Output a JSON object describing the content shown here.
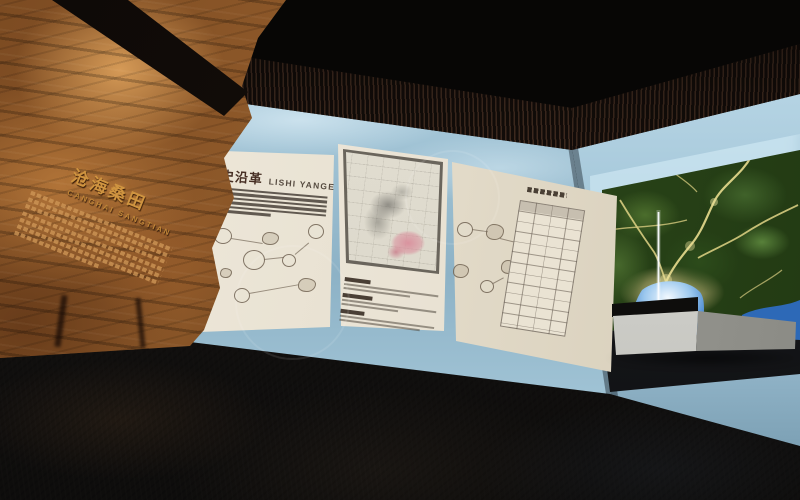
{
  "scene": {
    "type": "museum-exhibition-hall-3d-render",
    "areas": [
      "rock-relief-wall",
      "history-panel-wall",
      "terrain-map-wall",
      "dark-floor",
      "slatted-ceiling"
    ]
  },
  "rock_wall": {
    "carved_title": "沧海桑田",
    "carved_subtitle": "CANGHAI SANGTIAN",
    "carved_body_lines": 7
  },
  "center_wall": {
    "history_panel": {
      "title": "历史沿革",
      "subtitle": "LISHI YANGE",
      "paragraph_lines": 6,
      "callout_circles": 5
    },
    "map_panel": {
      "content": "historical-city-map",
      "highlight_color": "#d98f9c",
      "caption_sections": 3
    },
    "table_panel": {
      "content": "chronology-table-with-callouts",
      "callout_circles": 3,
      "table_rows": 12,
      "table_cols": 4
    }
  },
  "right_wall": {
    "display": "illuminated-satellite-terrain-map",
    "features": [
      "green-mountains",
      "yellow-river-valleys",
      "blue-lake",
      "white-marker-line"
    ],
    "furniture": "white-console-bench"
  },
  "colors": {
    "ceiling": "#0b0907",
    "grille": "#2a1f18",
    "wall_backdrop": "#a9cadb",
    "panel_paper": "#eae3d5",
    "rock_lit": "#b97a3e",
    "rock_dark": "#2c1507",
    "carved_gold": "#cf9440",
    "terrain_green": "#33521f",
    "terrain_valley": "#e4d687",
    "water_blue": "#3c85d8",
    "map_highlight_pink": "#d98f9c",
    "floor": "#131110"
  }
}
